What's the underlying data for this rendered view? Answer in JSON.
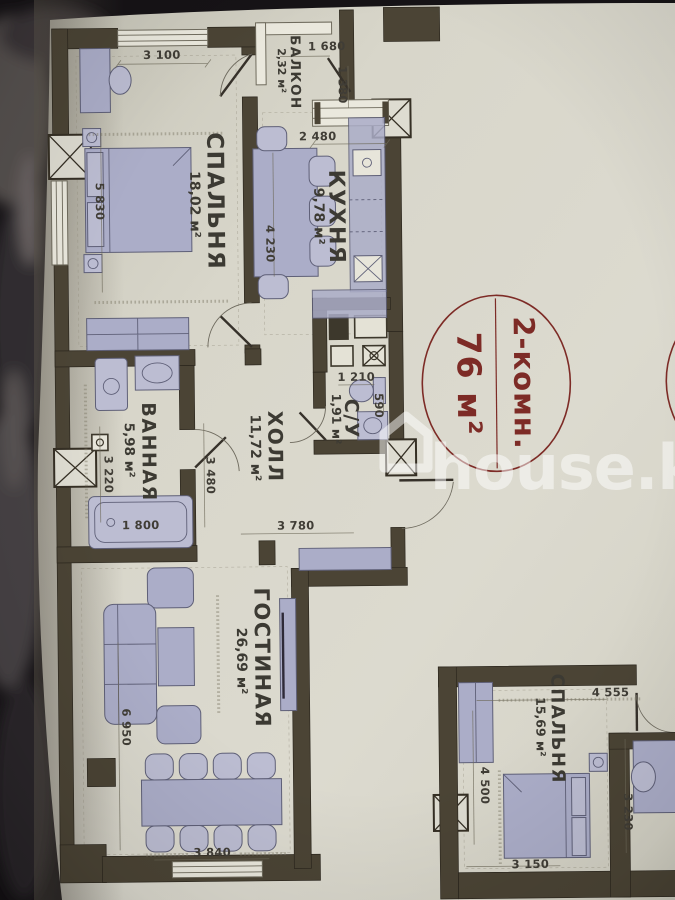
{
  "watermark": {
    "text": "house.kg"
  },
  "badge": {
    "line1": "2-комн.",
    "line2": "76 м²"
  },
  "colors": {
    "badge_red": "#7d2b26",
    "wall": "#4b4435",
    "furniture": "#abadc8",
    "paper": "#d8d6ca"
  },
  "rooms": {
    "bedroom1": {
      "name": "СПАЛЬНЯ",
      "area": "18,02 м²"
    },
    "kitchen": {
      "name": "КУХНЯ",
      "area": "9,78 м²"
    },
    "balcony": {
      "name": "БАЛКОН",
      "area": "2,32 м²"
    },
    "hall": {
      "name": "ХОЛЛ",
      "area": "11,72 м²"
    },
    "wc": {
      "name": "С/У",
      "area": "1,91 м²"
    },
    "bathroom": {
      "name": "ВАННАЯ",
      "area": "5,98 м²"
    },
    "living": {
      "name": "ГОСТИНАЯ",
      "area": "26,69 м²"
    },
    "bedroom2": {
      "name": "СПАЛЬНЯ",
      "area": "15,69 м²"
    }
  },
  "dims": {
    "d3100": "3 100",
    "d1680": "1 680",
    "d1380": "1 380",
    "d2480": "2 480",
    "d5830": "5 830",
    "d4230": "4 230",
    "d1210": "1 210",
    "d590": "590",
    "d3480": "3 480",
    "d3220": "3 220",
    "d1800": "1 800",
    "d3780": "3 780",
    "d6950": "6 950",
    "d3840": "3 840",
    "d4555": "4 555",
    "d4500": "4 500",
    "d3150": "3 150",
    "d3230": "3 230"
  }
}
